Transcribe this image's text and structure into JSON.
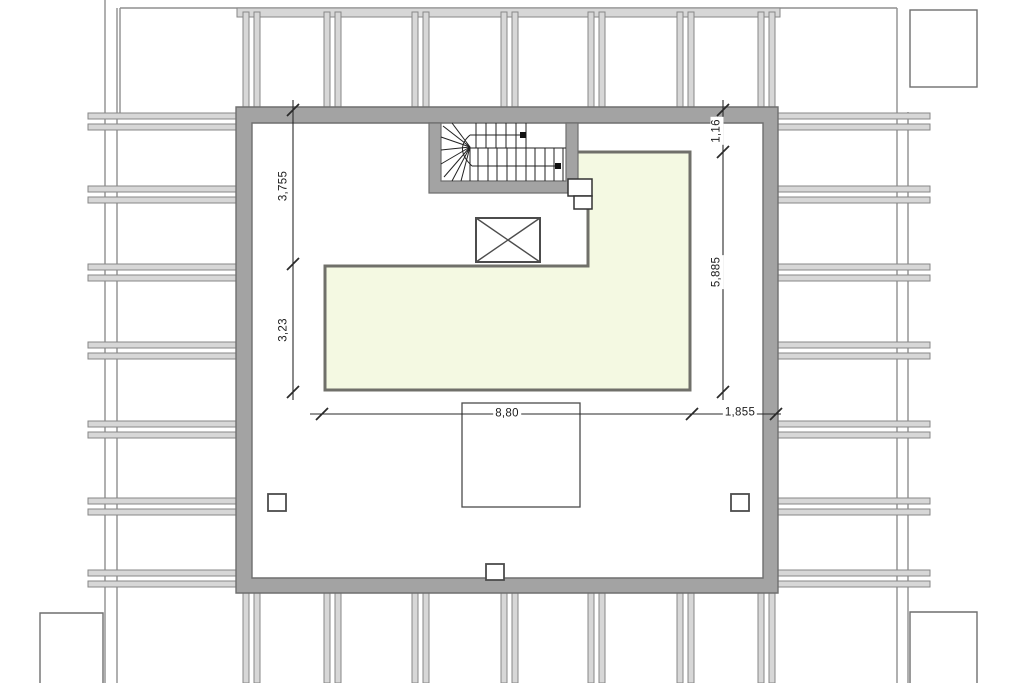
{
  "drawing": {
    "type": "architectural-floor-plan",
    "title": "roof / attic floor plan with stair, shaft and terrace",
    "dimensions": {
      "left": [
        {
          "label": "3,755"
        },
        {
          "label": "3,23"
        }
      ],
      "right": [
        {
          "label": "1,16"
        },
        {
          "label": "5,885"
        }
      ],
      "bottom": [
        {
          "label": "8,80"
        },
        {
          "label": "1,855"
        }
      ]
    },
    "colors": {
      "wall_fill": "#a3a3a3",
      "wall_edge": "#6f6f6f",
      "beam_fill": "#d7d7d7",
      "beam_edge": "#878787",
      "terrace_fill": "#f4f9e2",
      "terrace_edge": "#70706a",
      "line_dark": "#2a2a2a",
      "thin_line": "#8f8f8f",
      "paper": "#ffffff"
    },
    "elements": {
      "terrace": "roof-terrace-area",
      "stair": "winder-staircase",
      "shaft": "crossed-shaft-opening",
      "roof_opening": "roof-opening-rect",
      "columns": "column-markers",
      "grid": "exterior-beam-grid"
    }
  }
}
